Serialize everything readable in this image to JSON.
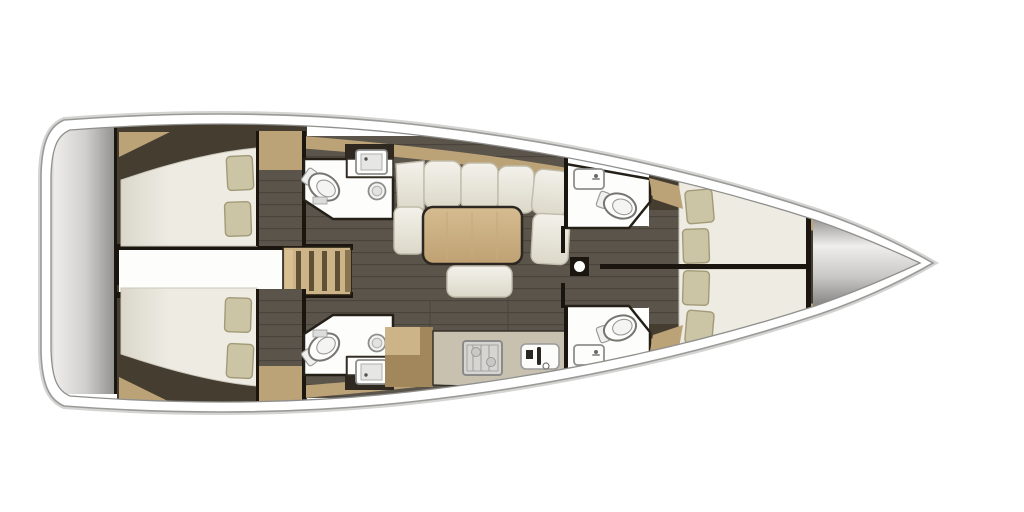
{
  "meta": {
    "title": "Sailing yacht interior floor plan (top view)",
    "type": "floor-plan",
    "orientation": "bow-right, stern-left"
  },
  "palette": {
    "background": "#ffffff",
    "hull_white": "#ffffff",
    "hull_stroke": "#9a9a98",
    "hull_outer_glow": "#d4d4d2",
    "inner_line": "#8f8f8d",
    "wall": "#1a150e",
    "dark_wood": "#453d30",
    "dark_wood_deep": "#2e2820",
    "floor": "#5a544b",
    "floor_line": "#4a443c",
    "wood": "#bca277",
    "wood_light": "#cdb488",
    "wood_dark": "#a2865c",
    "table_light": "#d5bc90",
    "table_dark": "#bfa173",
    "counter": "#c9c1b0",
    "mattress": "#edebe2",
    "mattress_shade": "#dbd7cb",
    "pillow": "#cbc5a6",
    "cushion_light": "#f3f1ea",
    "cushion_dark": "#dcd8c9",
    "room_white": "#fdfdfc",
    "stove_body": "#d6d5d1",
    "platform_edge": "#9f9e9c",
    "platform_light": "#eeedeb",
    "platform_mid": "#d0cfcd",
    "platform_dark": "#8b8a88",
    "bow_edge": "#989795",
    "bow_light": "#efeeec",
    "bow_mid": "#c9c8c6",
    "bow_dark": "#706f6d"
  },
  "areas": [
    {
      "id": "swim-platform",
      "label": "Stern swim platform"
    },
    {
      "id": "aft-cabin-port",
      "label": "Aft double cabin, port side",
      "pillows": 2
    },
    {
      "id": "aft-cabin-starboard",
      "label": "Aft double cabin, starboard side",
      "pillows": 2
    },
    {
      "id": "engine-corridor",
      "label": "Central passage between aft cabins"
    },
    {
      "id": "companionway",
      "label": "Companionway steps"
    },
    {
      "id": "head-aft-port",
      "label": "Aft head: toilet, washbasin, vanity (port)"
    },
    {
      "id": "head-aft-starboard",
      "label": "Aft head: toilet, washbasin, vanity (starboard)"
    },
    {
      "id": "saloon",
      "label": "Saloon: U-shaped settee, dining table, bench"
    },
    {
      "id": "galley",
      "label": "Galley: stove, sink, worktop"
    },
    {
      "id": "mast-post",
      "label": "Mast compression post"
    },
    {
      "id": "head-fwd-port",
      "label": "Forward head: toilet and sink (port)"
    },
    {
      "id": "head-fwd-starboard",
      "label": "Forward head: toilet and sink (starboard)"
    },
    {
      "id": "fwd-cabin-port",
      "label": "Forward double cabin, port side",
      "pillows": 2
    },
    {
      "id": "fwd-cabin-starboard",
      "label": "Forward double cabin, starboard side",
      "pillows": 2
    },
    {
      "id": "bow-locker",
      "label": "Bow anchor locker"
    }
  ]
}
